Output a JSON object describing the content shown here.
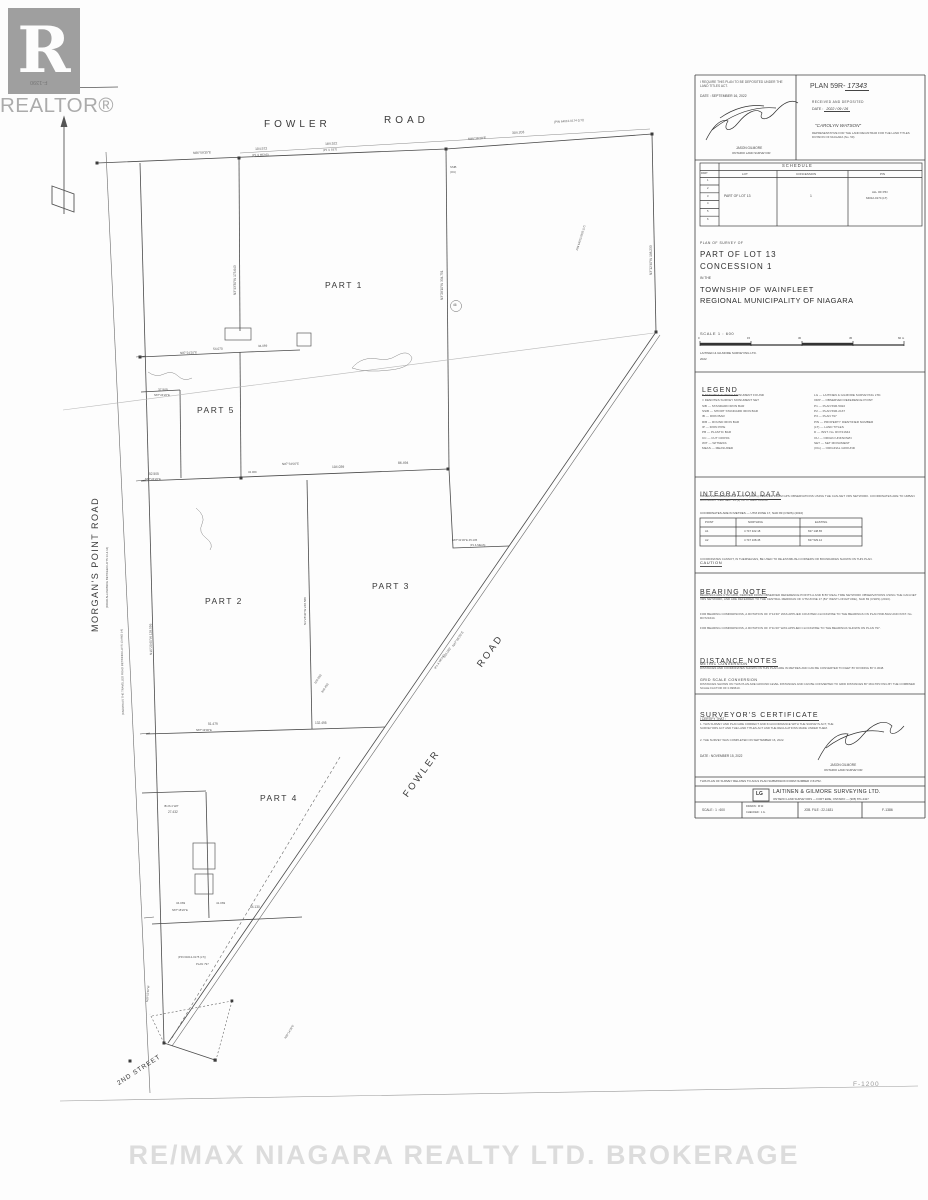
{
  "misc": {
    "watermark": "RE/MAX NIAGARA REALTY LTD. BROKERAGE",
    "corner_ref": "F-1200",
    "flipped_ref": "F-1390",
    "realtor_label": "REALTOR®",
    "realtor_r": "R"
  },
  "panel": {
    "deposit": {
      "require_line": "I REQUIRE THIS PLAN TO BE DEPOSITED UNDER THE LAND TITLES ACT.",
      "date_line": "DATE :  SEPTEMBER 16, 2022",
      "signer_name": "JASON GILMORE",
      "signer_title": "ONTARIO LAND SURVEYOR",
      "plan_prefix": "PLAN 59R-",
      "plan_number": "17343",
      "received": "RECEIVED AND DEPOSITED",
      "date_label": "DATE :",
      "date_value": "2022 / 09 / 26",
      "registrar": "\"CAROLYN WATSON\"",
      "rep_lines": "REPRESENTATIVE FOR THE LAND REGISTRAR FOR THE LAND TITLES DIVISION OF NIAGARA (No. 59)"
    },
    "title": {
      "line1": "PLAN OF SURVEY OF",
      "line2": "PART OF LOT 13",
      "line3": "CONCESSION 1",
      "line4": "IN THE",
      "line5": "TOWNSHIP OF WAINFLEET",
      "line6": "REGIONAL MUNICIPALITY OF NIAGARA",
      "scale": "SCALE  1 : 600",
      "firm": "LAITINEN & GILMORE SURVEYING LTD.",
      "year": "2022"
    },
    "legend": {
      "title": "LEGEND",
      "left": [
        "■   DENOTES   SURVEY MONUMENT FOUND",
        "□   DENOTES   SURVEY MONUMENT SET",
        "SIB    —    STANDARD IRON BAR",
        "SSIB   —    SHORT STANDARD IRON BAR",
        "IB     —    IRON BAR",
        "RIB    —    ROUND IRON BAR",
        "IP     —    IRON PIPE",
        "PB     —    PLASTIC BAR",
        "CC     —    CUT CROSS",
        "WIT    —    WITNESS",
        "MEAS   —    MEASURED"
      ],
      "right": [
        "LG     —    LAITINEN & GILMORE SURVEYING LTD.",
        "ORP    —    OBSERVED REFERENCE POINT",
        "P1     —    PLAN 59R-5022",
        "P2     —    PLAN 59R-2137",
        "P3     —    PLAN 797",
        "PIN    —    PROPERTY IDENTIFIER NUMBER",
        "(LT)   —    LAND TITLES",
        "D      —    INST. No. RO721644",
        "OU     —    ORIGIN UNKNOWN",
        "SET    —    SET MONUMENT",
        "(OG)   —    ORIGINAL GROUND"
      ]
    },
    "integration": {
      "title": "INTEGRATION  DATA",
      "para": "OBSERVED REFERENCE POINTS (ORPs) DERIVED FROM GPS OBSERVATIONS USING THE CAN-NET VRS NETWORK. COORDINATES ARE TO URBAN ACCURACY PER SEC. 14 (2) OF O. REG. 216/10.",
      "coord_note": "COORDINATES ARE IN METRES  —  UTM ZONE 17, NAD 83 (CSRS) (2010)",
      "caution_title": "CAUTION",
      "caution_text": "COORDINATES CANNOT, IN THEMSELVES, BE USED TO RE-ESTABLISH CORNERS OR BOUNDARIES SHOWN ON THIS PLAN."
    },
    "bearing": {
      "title": "BEARING  NOTE",
      "p1": "BEARINGS ARE UTM GRID, DERIVED FROM OBSERVED REFERENCE POINTS A AND B BY REAL TIME NETWORK OBSERVATIONS USING THE CAN-NET VRS NETWORK, AND ARE REFERRED TO THE CENTRAL MERIDIAN OF UTM ZONE 17 (81° WEST LONGITUDE), NAD 83 (CSRS) (2010).",
      "p2": "FOR BEARING COMPARISONS, A ROTATION OF 0°14'40\" WAS APPLIED COUNTER-CLOCKWISE TO THE BEARINGS ON PLAN 59R-5022 AND INST. No. RO721644.",
      "p3": "FOR BEARING COMPARISONS, A ROTATION OF 0°11'40\" WAS APPLIED CLOCKWISE TO THE BEARINGS SHOWN ON PLAN 797."
    },
    "distance": {
      "title": "DISTANCE  NOTES",
      "sub1": "METRIC  CONVERSION",
      "t1": "DISTANCES AND COORDINATES SHOWN ON THIS PLAN ARE IN METRES AND CAN BE CONVERTED TO FEET BY DIVIDING BY 0.3048.",
      "sub2": "GRID  SCALE  CONVERSION",
      "t2": "DISTANCES SHOWN ON THIS PLAN ARE GROUND LEVEL DISTANCES AND CAN BE CONVERTED TO GRID DISTANCES BY MULTIPLYING BY THE COMBINED SCALE FACTOR OF 0.999610."
    },
    "certificate": {
      "title": "SURVEYOR'S  CERTIFICATE",
      "intro": "I CERTIFY THAT :",
      "item1": "1.  THIS SURVEY AND PLAN ARE CORRECT AND IN ACCORDANCE WITH THE SURVEYS ACT, THE SURVEYORS ACT AND THE LAND TITLES ACT AND THE REGULATIONS MADE UNDER THEM.",
      "item2": "2.  THE SURVEY WAS COMPLETED ON SEPTEMBER 16, 2022.",
      "date_line": "DATE :   NOVEMBER 15, 2022",
      "name": "JASON GILMORE",
      "role": "ONTARIO LAND SURVEYOR"
    },
    "submission_note": "THIS PLAN OF SURVEY RELATES TO AOLS PLAN SUBMISSION FORM NUMBER  V-51752.",
    "company": {
      "logo": "LG",
      "name": "LAITINEN & GILMORE SURVEYING LTD.",
      "sub": "ONTARIO LAND SURVEYORS  —  FORT ERIE, ONTARIO  —  (905) 871-2427"
    },
    "footer": {
      "scale": "SCALE :  1 : 600",
      "drawn": "DRAWN :  M.W.",
      "checked": "CHECKED :  J.G.",
      "job": "JOB. FILE :  22-1631",
      "sheet": "F-1386"
    }
  },
  "panel_annotations": [
    {
      "text": "SCHEDULE",
      "x": 782,
      "y": 163.5,
      "size": 4.2,
      "ls": 1
    },
    {
      "text": "PART",
      "x": 701,
      "y": 173,
      "size": 2.6
    },
    {
      "text": "LOT",
      "x": 742,
      "y": 172.5,
      "size": 3
    },
    {
      "text": "CONCESSION",
      "x": 796,
      "y": 172.5,
      "size": 3
    },
    {
      "text": "PIN",
      "x": 880,
      "y": 172.5,
      "size": 3
    },
    {
      "text": "1",
      "x": 707,
      "y": 180,
      "size": 2.7
    },
    {
      "text": "2",
      "x": 707,
      "y": 187.8,
      "size": 2.7
    },
    {
      "text": "3",
      "x": 707,
      "y": 195.6,
      "size": 2.7
    },
    {
      "text": "4",
      "x": 707,
      "y": 203.4,
      "size": 2.7
    },
    {
      "text": "5",
      "x": 707,
      "y": 211.2,
      "size": 2.7
    },
    {
      "text": "6",
      "x": 707,
      "y": 219,
      "size": 2.7
    },
    {
      "text": "PART OF LOT 13",
      "x": 724,
      "y": 195,
      "size": 3.4
    },
    {
      "text": "1",
      "x": 810,
      "y": 195,
      "size": 3.4
    },
    {
      "text": "ALL OF PIN",
      "x": 872,
      "y": 191,
      "size": 2.9
    },
    {
      "text": "64012-0174 (LT)",
      "x": 866,
      "y": 196.5,
      "size": 2.9
    },
    {
      "text": "0",
      "x": 698,
      "y": 336.5,
      "size": 2.8
    },
    {
      "text": "15",
      "x": 747,
      "y": 336.5,
      "size": 2.8
    },
    {
      "text": "30",
      "x": 798,
      "y": 336.5,
      "size": 2.8
    },
    {
      "text": "45",
      "x": 849,
      "y": 336.5,
      "size": 2.8
    },
    {
      "text": "60 m",
      "x": 898,
      "y": 336.5,
      "size": 2.8
    },
    {
      "text": "POINT",
      "x": 705,
      "y": 520.5,
      "size": 2.8
    },
    {
      "text": "NORTHING",
      "x": 748,
      "y": 520.5,
      "size": 2.8
    },
    {
      "text": "EASTING",
      "x": 815,
      "y": 520.5,
      "size": 2.8
    },
    {
      "text": "A1",
      "x": 705,
      "y": 529.5,
      "size": 2.8
    },
    {
      "text": "4 747 322.18",
      "x": 744,
      "y": 529.5,
      "size": 2.8
    },
    {
      "text": "637 148.65",
      "x": 808,
      "y": 529.5,
      "size": 2.8
    },
    {
      "text": "A2",
      "x": 705,
      "y": 538.5,
      "size": 2.8
    },
    {
      "text": "4 747 108.45",
      "x": 744,
      "y": 538.5,
      "size": 2.8
    },
    {
      "text": "637 529.12",
      "x": 808,
      "y": 538.5,
      "size": 2.8
    }
  ],
  "map": {
    "part_labels": [
      {
        "text": "PART 1",
        "x": 325,
        "y": 280
      },
      {
        "text": "PART 2",
        "x": 205,
        "y": 596
      },
      {
        "text": "PART 3",
        "x": 372,
        "y": 581
      },
      {
        "text": "PART 4",
        "x": 260,
        "y": 793
      },
      {
        "text": "PART 5",
        "x": 197,
        "y": 405
      }
    ],
    "road_labels": [
      {
        "text": "FOWLER",
        "x": 264,
        "y": 119,
        "size": 10,
        "ls": 4
      },
      {
        "text": "ROAD",
        "x": 384,
        "y": 115,
        "size": 10,
        "ls": 4
      },
      {
        "text": "MORGAN'S  POINT  ROAD",
        "x": 90,
        "y": 632,
        "size": 9,
        "ls": 1.5,
        "rot": -90
      },
      {
        "text": "FOWLER",
        "x": 401,
        "y": 793,
        "size": 9.5,
        "ls": 2.5,
        "rot": -54
      },
      {
        "text": "ROAD",
        "x": 475,
        "y": 663,
        "size": 9.5,
        "ls": 2.5,
        "rot": -54
      },
      {
        "text": "2ND  STREET",
        "x": 116,
        "y": 1081,
        "size": 6.5,
        "ls": 1,
        "rot": -33
      }
    ],
    "annotations": [
      {
        "text": "N86°59'35\"E",
        "x": 193,
        "y": 152,
        "size": 3.2,
        "rot": -2
      },
      {
        "text": "104.572",
        "x": 255,
        "y": 148,
        "size": 3.4,
        "rot": -2
      },
      {
        "text": "(P1 & MEAS)",
        "x": 252,
        "y": 153.5,
        "size": 2.8,
        "rot": -2
      },
      {
        "text": "184.522",
        "x": 325,
        "y": 143,
        "size": 3.4,
        "rot": -3
      },
      {
        "text": "(P1 & SET)",
        "x": 323,
        "y": 148.5,
        "size": 2.8,
        "rot": -3
      },
      {
        "text": "304.203",
        "x": 512,
        "y": 132,
        "size": 3.4,
        "rot": -4
      },
      {
        "text": "N86°36'20\"E",
        "x": 468,
        "y": 138,
        "size": 3.2,
        "rot": -4
      },
      {
        "text": "(PIN 64012-0174 (LT))",
        "x": 554,
        "y": 121,
        "size": 3,
        "rot": -4
      },
      {
        "text": "SSIB",
        "x": 450,
        "y": 166,
        "size": 2.8
      },
      {
        "text": "(OU)",
        "x": 450,
        "y": 171,
        "size": 2.8
      },
      {
        "text": "N3°28'10\"W   334.751",
        "x": 441,
        "y": 300,
        "size": 3.2,
        "rot": -90
      },
      {
        "text": "N3°43'30\"W   173.643",
        "x": 234,
        "y": 295,
        "size": 3.2,
        "rot": -90
      },
      {
        "text": "N3°12'40\"W   198.233",
        "x": 650,
        "y": 275,
        "size": 3.2,
        "rot": -90
      },
      {
        "text": "N16°20'40\"W   128.556",
        "x": 150,
        "y": 655,
        "size": 3.2,
        "rot": -91
      },
      {
        "text": "(KNOWN AS THE TRAVELLED ROAD BETWEEN LOTS 13 AND 14)",
        "x": 122,
        "y": 715,
        "size": 2.8,
        "rot": -91
      },
      {
        "text": "(ROAD ALLOWANCE BETWEEN LOTS 13 & 14)",
        "x": 106,
        "y": 608,
        "size": 2.8,
        "rot": -90
      },
      {
        "text": "PIN 64013-0303 (LT)",
        "x": 576,
        "y": 250,
        "size": 2.8,
        "rot": -73
      },
      {
        "text": "N87°24'20\"E",
        "x": 180,
        "y": 352,
        "size": 3,
        "rot": -2
      },
      {
        "text": "54.070",
        "x": 213,
        "y": 347.5,
        "size": 3.2,
        "rot": -2
      },
      {
        "text": "34.069",
        "x": 258,
        "y": 344.5,
        "size": 3,
        "rot": -2
      },
      {
        "text": "37.505",
        "x": 158,
        "y": 389,
        "size": 3.2
      },
      {
        "text": "N87°24'20\"E",
        "x": 154,
        "y": 394,
        "size": 2.8
      },
      {
        "text": "52.505",
        "x": 149,
        "y": 473,
        "size": 3.2
      },
      {
        "text": "N87°24'20\"E",
        "x": 145,
        "y": 478,
        "size": 2.8
      },
      {
        "text": "N87°34'00\"E",
        "x": 282,
        "y": 462.5,
        "size": 3,
        "rot": -1
      },
      {
        "text": "104.039",
        "x": 332,
        "y": 465.5,
        "size": 3.4,
        "rot": -1
      },
      {
        "text": "86.494",
        "x": 398,
        "y": 461.5,
        "size": 3.4,
        "rot": -1
      },
      {
        "text": "34.069",
        "x": 248,
        "y": 470.5,
        "size": 2.8
      },
      {
        "text": "N87°31'30\"E   45.105",
        "x": 452,
        "y": 539,
        "size": 2.8
      },
      {
        "text": "(P1 & MEAS)",
        "x": 470,
        "y": 545,
        "size": 2.6
      },
      {
        "text": "N3°28'30\"W   248.588",
        "x": 304,
        "y": 625,
        "size": 3,
        "rot": -90
      },
      {
        "text": "51.479",
        "x": 208,
        "y": 722.5,
        "size": 3.2
      },
      {
        "text": "N87°19'00\"E",
        "x": 196,
        "y": 728.5,
        "size": 2.8
      },
      {
        "text": "132.495",
        "x": 315,
        "y": 721.5,
        "size": 3.2
      },
      {
        "text": "N47°46'20\"E",
        "x": 452,
        "y": 646,
        "size": 3.2,
        "rot": -56
      },
      {
        "text": "134.092",
        "x": 443,
        "y": 657,
        "size": 3.2,
        "rot": -56
      },
      {
        "text": "(P1 & MEAS)",
        "x": 434,
        "y": 668,
        "size": 2.8,
        "rot": -56
      },
      {
        "text": "104.093",
        "x": 314,
        "y": 683,
        "size": 3,
        "rot": -56
      },
      {
        "text": "316.493",
        "x": 321,
        "y": 692,
        "size": 3,
        "rot": -56
      },
      {
        "text": "27.432",
        "x": 168,
        "y": 811,
        "size": 3.2
      },
      {
        "text": "IB 26.4 WIT",
        "x": 164,
        "y": 805,
        "size": 2.8
      },
      {
        "text": "34.069",
        "x": 176,
        "y": 902,
        "size": 3
      },
      {
        "text": "41.069",
        "x": 216,
        "y": 902,
        "size": 3
      },
      {
        "text": "N87°18'20\"E",
        "x": 172,
        "y": 908.5,
        "size": 2.8
      },
      {
        "text": "64.130",
        "x": 250,
        "y": 906,
        "size": 3.2
      },
      {
        "text": "N36°14'30\"E",
        "x": 284,
        "y": 1038,
        "size": 2.8,
        "rot": -58
      },
      {
        "text": "(PIN 64012-0175 (LT))",
        "x": 178,
        "y": 956,
        "size": 2.8
      },
      {
        "text": "PLAN 797",
        "x": 196,
        "y": 963,
        "size": 2.8
      },
      {
        "text": "N28°52'30\"W",
        "x": 146,
        "y": 1002,
        "size": 2.8,
        "rot": -85
      },
      {
        "text": "46",
        "x": 453,
        "y": 303.5,
        "size": 3.2
      }
    ]
  }
}
